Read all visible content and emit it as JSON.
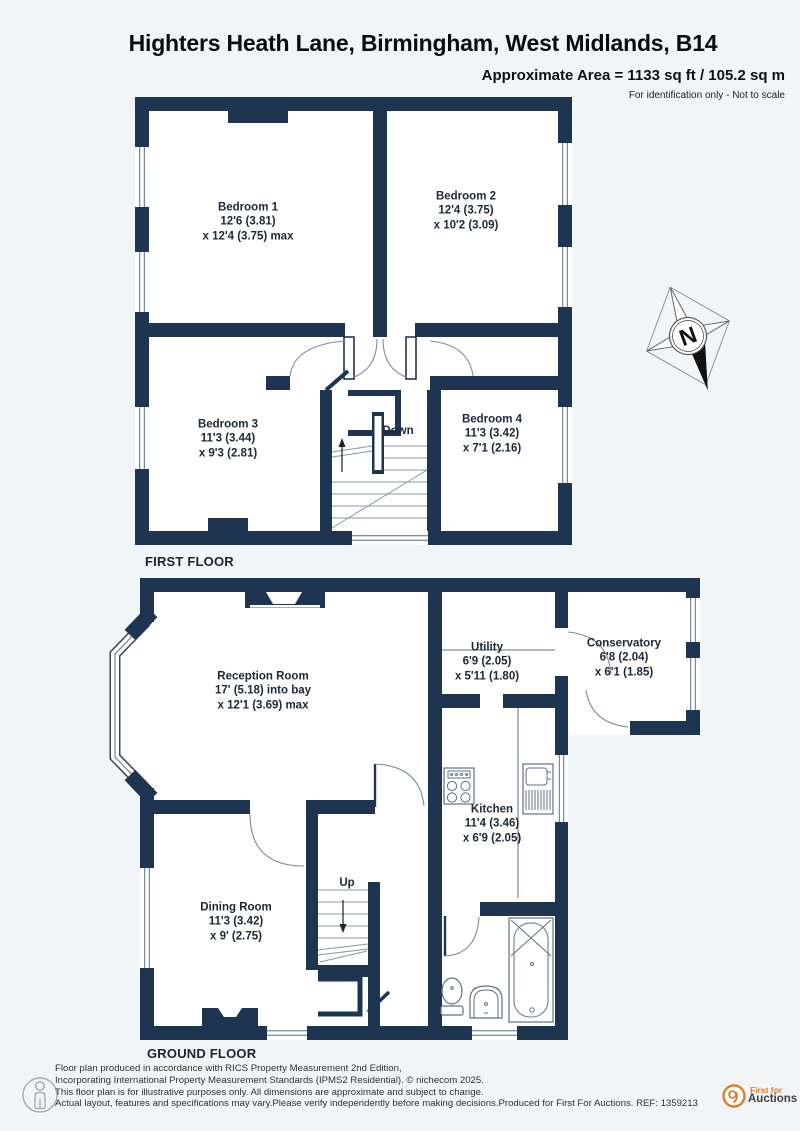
{
  "header": {
    "title": "Highters Heath Lane, Birmingham, West Midlands, B14",
    "approx_area": "Approximate Area = 1133 sq ft / 105.2 sq m",
    "note": "For identification only - Not to scale"
  },
  "floors": [
    {
      "label": "FIRST FLOOR",
      "stair_label": "Down",
      "rooms": [
        {
          "name": "Bedroom 1",
          "line1": "12'6 (3.81)",
          "line2": "x 12'4 (3.75) max"
        },
        {
          "name": "Bedroom 2",
          "line1": "12'4 (3.75)",
          "line2": "x 10'2 (3.09)"
        },
        {
          "name": "Bedroom 3",
          "line1": "11'3 (3.44)",
          "line2": "x 9'3 (2.81)"
        },
        {
          "name": "Bedroom 4",
          "line1": "11'3 (3.42)",
          "line2": "x 7'1 (2.16)"
        }
      ]
    },
    {
      "label": "GROUND FLOOR",
      "stair_label": "Up",
      "rooms": [
        {
          "name": "Reception Room",
          "line1": "17' (5.18) into bay",
          "line2": "x 12'1 (3.69) max"
        },
        {
          "name": "Utility",
          "line1": "6'9 (2.05)",
          "line2": "x 5'11 (1.80)"
        },
        {
          "name": "Conservatory",
          "line1": "6'8 (2.04)",
          "line2": "x 6'1 (1.85)"
        },
        {
          "name": "Kitchen",
          "line1": "11'4 (3.46)",
          "line2": "x 6'9 (2.05)"
        },
        {
          "name": "Dining Room",
          "line1": "11'3 (3.42)",
          "line2": "x 9' (2.75)"
        }
      ]
    }
  ],
  "compass": {
    "north_label": "N"
  },
  "footer": {
    "disclaimer_lines": [
      "Floor plan produced in accordance with RICS Property Measurement 2nd Edition,",
      "Incorporating International Property Measurement Standards (IPMS2 Residential).   © nichecom 2025.",
      "This floor plan is for illustrative purposes only. All dimensions are approximate and subject to change.",
      "Actual layout, features and specifications may vary.Please verify independently before making decisions.Produced for First For Auctions.   REF:  1359213"
    ],
    "logo": {
      "line1": "First for",
      "line2": "Auctions"
    }
  },
  "colors": {
    "wall": "#1d3551",
    "logo_orange": "#e07c26",
    "background": "#f2f5f8"
  }
}
